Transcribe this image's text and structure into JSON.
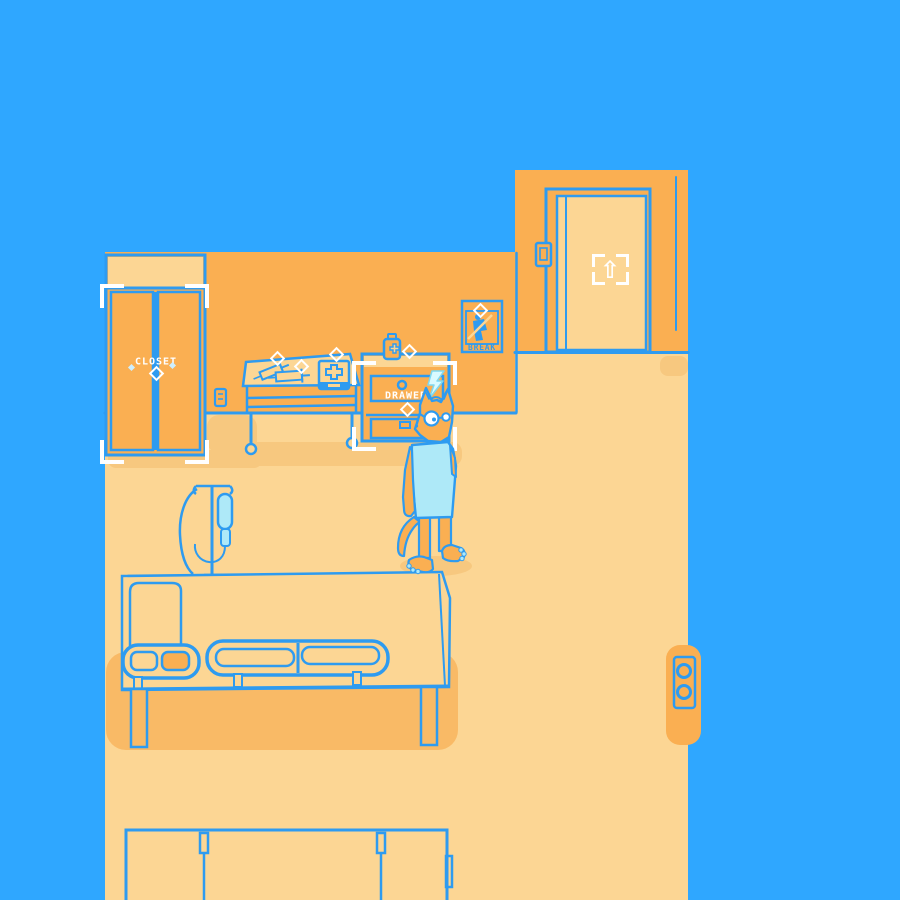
{
  "palette": {
    "background_blue": "#2FA7FF",
    "outline_blue": "#2E9BF0",
    "wall_orange": "#FAAF52",
    "floor_orange": "#FCD694",
    "soft_shadow_orange": "#F7C87F",
    "deep_shadow_orange": "#F9BA66",
    "gown_cyan": "#AEE9F8",
    "emote_cyan": "#D9FAFF",
    "white": "#FFFFFF"
  },
  "objects": {
    "closet": {
      "label": "CLOSET"
    },
    "drawer": {
      "label": "DRAWER"
    },
    "poster_sign": {
      "label": "BREAK"
    },
    "door": {
      "interact_glyph": "⇧"
    }
  },
  "icons": {
    "sparkle_glyph": "◇",
    "interact_arrow_glyph": "⇧",
    "player_emote": "lightning-bolt"
  }
}
